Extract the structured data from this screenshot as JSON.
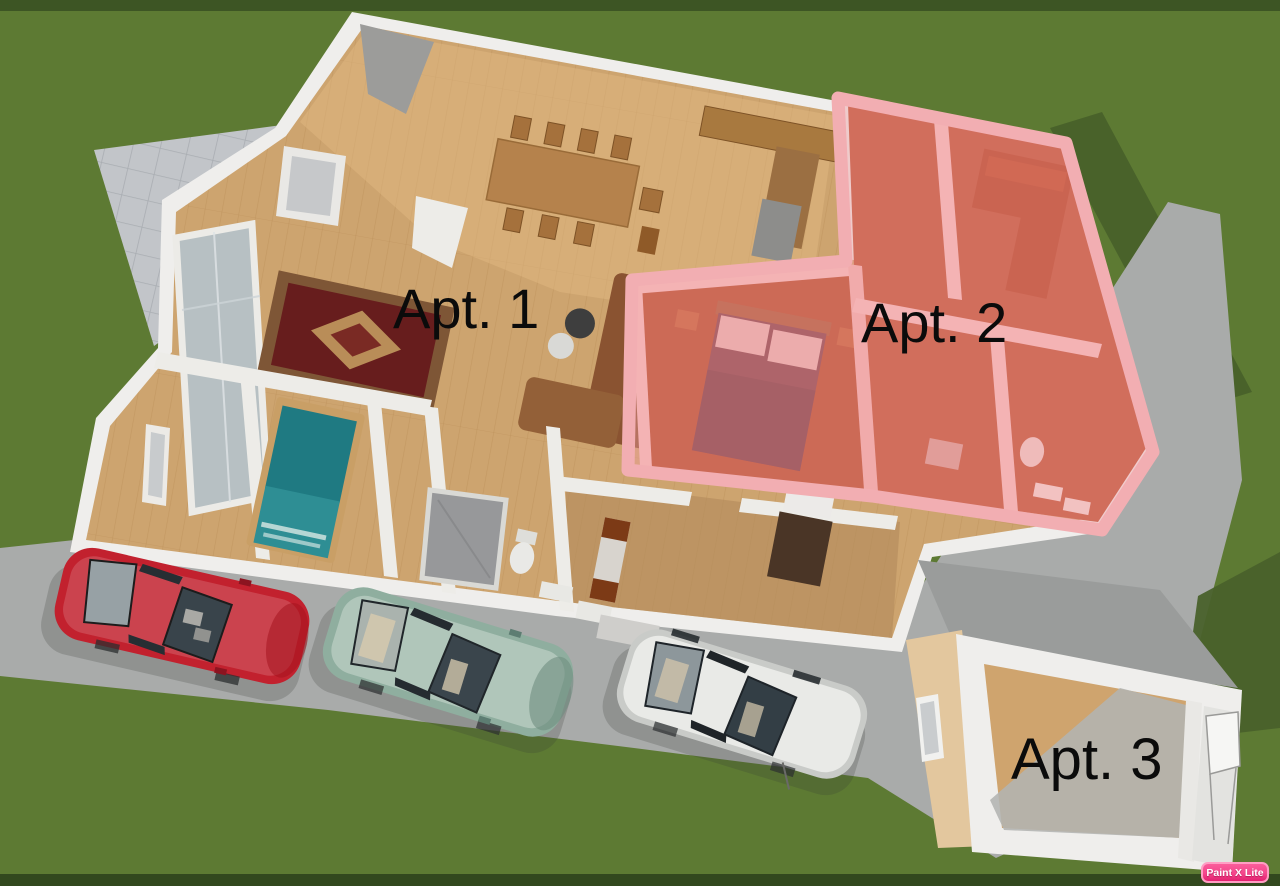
{
  "scene": {
    "description": "3D aerial floor plan rendering of a property divided into three apartments, with driveway and parked cars",
    "labels": {
      "apt1": "Apt. 1",
      "apt2": "Apt. 2",
      "apt3": "Apt. 3"
    },
    "watermark": "Paint X Lite",
    "colors": {
      "grass": "#5d7a33",
      "grass_shadow": "#48612a",
      "driveway": "#a9abaa",
      "patio_tile": "#c2c5c9",
      "wall": "#efeeec",
      "wood_floor": "#cda46f",
      "apt2_overlay": "#f2a3a8",
      "apt2_floor": "#b84c2a",
      "rug": "#671d1d",
      "bed_teal": "#1f7a82",
      "car_red": "#c2212e",
      "car_teal": "#8fae9f",
      "car_white": "#e9eae7",
      "watermark_pink": "#f4478c"
    },
    "objects": [
      "stone patio",
      "driveway",
      "main house",
      "dining table with chairs",
      "kitchen cabinets",
      "oriental rug",
      "bay window",
      "brown sofa",
      "teal bed",
      "bathroom with shower and toilet",
      "apt2 double bed",
      "apt2 sectional sofa",
      "apt2 bathroom",
      "detached studio",
      "red sedan",
      "teal sedan",
      "white sedan"
    ]
  }
}
